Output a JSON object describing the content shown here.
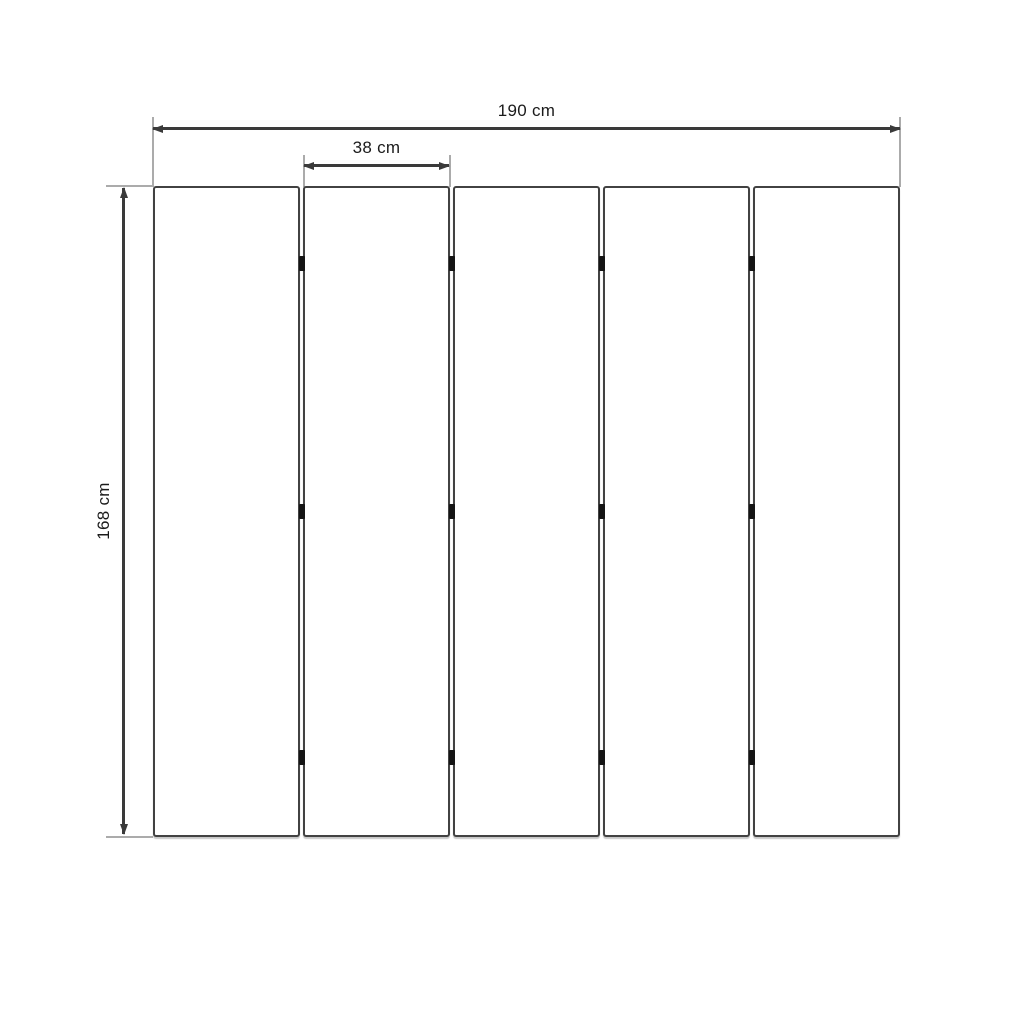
{
  "diagram": {
    "type": "dimension-drawing",
    "subject": "five-panel folding screen front view",
    "dimensions": {
      "total_width": "190 cm",
      "panel_width": "38 cm",
      "height": "168 cm"
    },
    "panel_count": 5,
    "hinge_columns": 4,
    "hinge_rows": 3,
    "colors": {
      "panel_border": "#424242",
      "dimension_line": "#3a3a3a",
      "extension_line": "#ababab",
      "hinge": "#141414",
      "label_text": "#1b1b1b",
      "background": "#ffffff"
    }
  }
}
